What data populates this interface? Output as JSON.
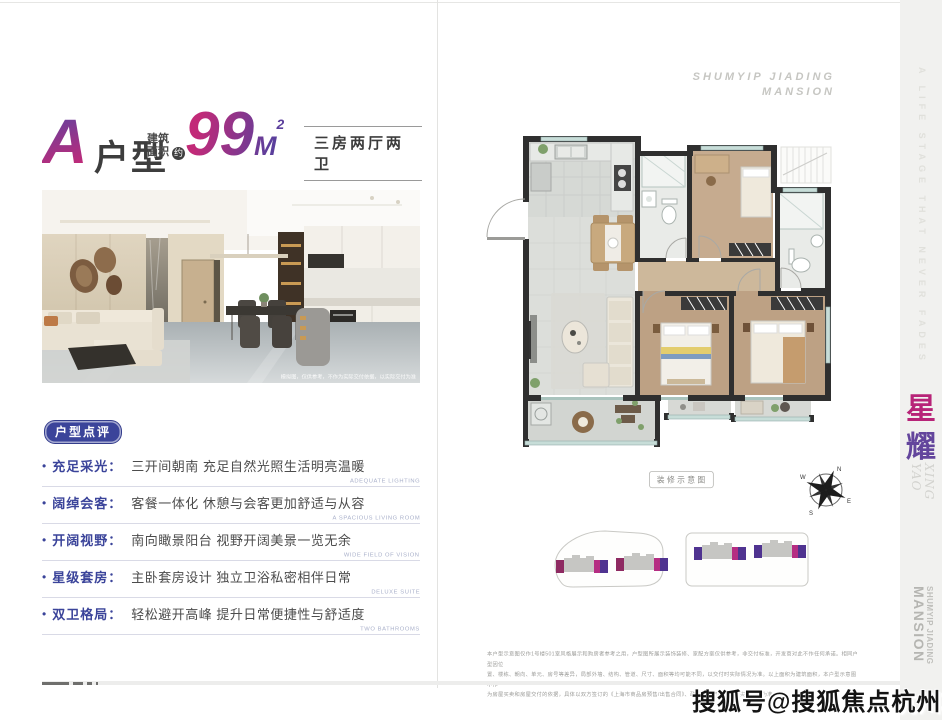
{
  "header": {
    "unit_letter": "A",
    "unit_type_label": "户型",
    "area_label_line1": "建筑",
    "area_label_line2": "面积",
    "area_approx": "约",
    "area_number": "99",
    "area_unit": "M",
    "area_exponent": "2",
    "layout_summary": "三房两厅两卫"
  },
  "photo": {
    "caption": "模拟图，仅供参考，不作为实际交付依据，以实际交付为准"
  },
  "review": {
    "badge": "户型点评",
    "items": [
      {
        "label": "充足采光：",
        "desc": "三开间朝南 充足自然光照生活明亮温暖",
        "en": "ADEQUATE LIGHTING"
      },
      {
        "label": "阔绰会客：",
        "desc": "客餐一体化 休憩与会客更加舒适与从容",
        "en": "A SPACIOUS LIVING ROOM"
      },
      {
        "label": "开阔视野：",
        "desc": "南向瞰景阳台 视野开阔美景一览无余",
        "en": "WIDE FIELD OF VISION"
      },
      {
        "label": "星级套房：",
        "desc": "主卧套房设计 独立卫浴私密相伴日常",
        "en": "DELUXE SUITE"
      },
      {
        "label": "双卫格局：",
        "desc": "轻松避开高峰 提升日常便捷性与舒适度",
        "en": "TWO BATHROOMS"
      }
    ]
  },
  "plan_page": {
    "brand_line1": "SHUMYIP JIADING",
    "brand_line2": "MANSION",
    "plan_label": "装修示意图",
    "compass": {
      "n": "N",
      "e": "E",
      "s": "S",
      "w": "W"
    },
    "disclaimer_line1": "本户型示意图仅作1号楼501室风格展示和购房者参考之用，户型图所展示装饰装修、家配方案仅供参考，非交付标准，开发商对此不作任何承诺。相同户型因位",
    "disclaimer_line2": "置、楼栋、朝向、单元、房号等差异，局部外墙、结构、管道、尺寸、面积等均可能不同，以交付时实际情况为准。以上面积为建筑面积，本户型示意图不作",
    "disclaimer_line3": "为房屋买卖和房屋交付的依据，具体以双方签订的《上海市商品房预售/出售合同》、政府最终审批文件及实际交付为准。"
  },
  "sidebar": {
    "tagline": "A LIFE STAGE THAT NEVER FADES",
    "logo_char_top": "星",
    "logo_char_bottom": "耀",
    "logo_en_line1": "XING",
    "logo_en_line2": "YAO",
    "brand_line1": "SHUMYIP JIADING",
    "brand_line2": "MANSION"
  },
  "watermark": "搜狐号@搜狐焦点杭州站",
  "colors": {
    "accent_pink": "#c22a78",
    "accent_purple": "#5b3f9c",
    "label_indigo": "#3b449a",
    "wall_dark": "#2f2f2f",
    "wood_floor": "#bda184",
    "tile_floor": "#dcdeda"
  }
}
